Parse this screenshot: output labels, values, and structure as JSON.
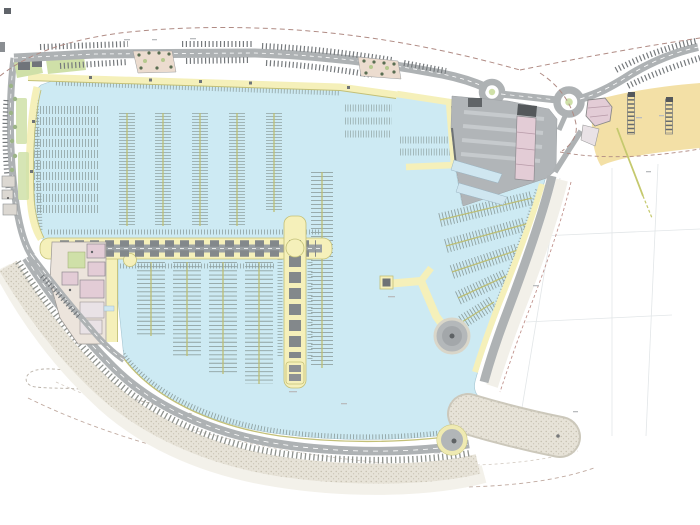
{
  "document": {
    "kind": "marina-master-plan-drawing",
    "background": "#ffffff"
  },
  "palette": {
    "water": "#cdeaf3",
    "waterEdge": "#a6c6d2",
    "quay": "#f5f0ba",
    "quayEdge": "#c3c077",
    "road": "#aeb2b4",
    "roadMinor": "#9aa0a3",
    "parking": "#75797c",
    "crest": "#8e928e",
    "comb": "#90a2a2",
    "pline": "#bcbe75",
    "sand": "#f3e0a6",
    "green": "#cfe0a8",
    "pink": "#e3ccd6",
    "bld": "#8d9194",
    "bldD": "#54585b",
    "stippleBase": "#e7e3d8",
    "stippleDot": "#c3bdad",
    "bound": "#b08b84",
    "bound2": "#c0aaa0",
    "grid": "#e2e6e8",
    "outerBand": "#f2f0e9",
    "beachBand": "#f3f1ea",
    "complex": "#ece4dc",
    "ramp": "#cfe6f0",
    "annex": "#e9e2e6"
  },
  "berths": {
    "groups": [
      {
        "name": "north-small-pontoons",
        "orient": "v",
        "teeth_w": 16,
        "tooth": 0.8,
        "pitch": 3,
        "walkway": true,
        "items": [
          {
            "x": 127,
            "y1": 113,
            "y2": 226
          },
          {
            "x": 163,
            "y1": 113,
            "y2": 226
          },
          {
            "x": 200,
            "y1": 113,
            "y2": 226
          },
          {
            "x": 237,
            "y1": 113,
            "y2": 226
          },
          {
            "x": 274,
            "y1": 113,
            "y2": 212
          }
        ]
      },
      {
        "name": "west-inshore-rows",
        "orient": "h",
        "teeth_w": 8,
        "tooth": 0.8,
        "pitch": 3,
        "walkway": false,
        "items": [
          {
            "y": 110,
            "x1": 28,
            "x2": 98
          },
          {
            "y": 121,
            "x1": 28,
            "x2": 98
          },
          {
            "y": 132,
            "x1": 28,
            "x2": 98
          },
          {
            "y": 143,
            "x1": 28,
            "x2": 98
          },
          {
            "y": 154,
            "x1": 28,
            "x2": 98
          },
          {
            "y": 165,
            "x1": 28,
            "x2": 98
          },
          {
            "y": 176,
            "x1": 28,
            "x2": 98
          },
          {
            "y": 187,
            "x1": 28,
            "x2": 98
          },
          {
            "y": 198,
            "x1": 28,
            "x2": 98
          },
          {
            "y": 209,
            "x1": 28,
            "x2": 98
          }
        ]
      },
      {
        "name": "mid-east-pontoon",
        "orient": "v",
        "teeth_w": 22,
        "tooth": 0.9,
        "pitch": 4,
        "walkway": true,
        "items": [
          {
            "x": 322,
            "y1": 172,
            "y2": 368
          }
        ]
      },
      {
        "name": "south-main-pontoons",
        "orient": "v",
        "teeth_w": 28,
        "tooth": 0.9,
        "pitch": 4.2,
        "walkway": true,
        "items": [
          {
            "x": 151,
            "y1": 262,
            "y2": 336
          },
          {
            "x": 187,
            "y1": 262,
            "y2": 356
          },
          {
            "x": 223,
            "y1": 262,
            "y2": 374
          },
          {
            "x": 259,
            "y1": 262,
            "y2": 384
          }
        ]
      },
      {
        "name": "small-craft-basin-rows",
        "orient": "h",
        "teeth_w": 7,
        "tooth": 0.7,
        "pitch": 2.6,
        "walkway": false,
        "items": [
          {
            "y": 108,
            "x1": 345,
            "x2": 392
          },
          {
            "y": 121,
            "x1": 345,
            "x2": 392
          },
          {
            "y": 134,
            "x1": 345,
            "x2": 390
          },
          {
            "y": 140,
            "x1": 400,
            "x2": 452
          },
          {
            "y": 152,
            "x1": 400,
            "x2": 452
          }
        ]
      },
      {
        "name": "east-angled-pontoons",
        "orient": "seg",
        "teeth_w": 14,
        "tooth": 0.9,
        "pitch": 3.2,
        "walkway": true,
        "items": [
          {
            "x1": 440,
            "y1": 220,
            "x2": 532,
            "y2": 198
          },
          {
            "x1": 446,
            "y1": 246,
            "x2": 526,
            "y2": 224
          },
          {
            "x1": 452,
            "y1": 272,
            "x2": 518,
            "y2": 250
          },
          {
            "x1": 458,
            "y1": 298,
            "x2": 506,
            "y2": 276
          },
          {
            "x1": 462,
            "y1": 322,
            "x2": 494,
            "y2": 302
          }
        ]
      },
      {
        "name": "quay-side-ties",
        "orient": "seg",
        "teeth_w": 5,
        "tooth": 0.8,
        "pitch": 3,
        "walkway": false,
        "items": [
          {
            "x1": 56,
            "y1": 83,
            "x2": 340,
            "y2": 93
          },
          {
            "x1": 36,
            "y1": 100,
            "x2": 40,
            "y2": 230
          },
          {
            "x1": 48,
            "y1": 232,
            "x2": 320,
            "y2": 232
          },
          {
            "x1": 48,
            "y1": 266,
            "x2": 276,
            "y2": 266
          },
          {
            "x1": 280,
            "y1": 256,
            "x2": 280,
            "y2": 358
          },
          {
            "x1": 310,
            "y1": 256,
            "x2": 310,
            "y2": 360
          }
        ]
      }
    ]
  }
}
